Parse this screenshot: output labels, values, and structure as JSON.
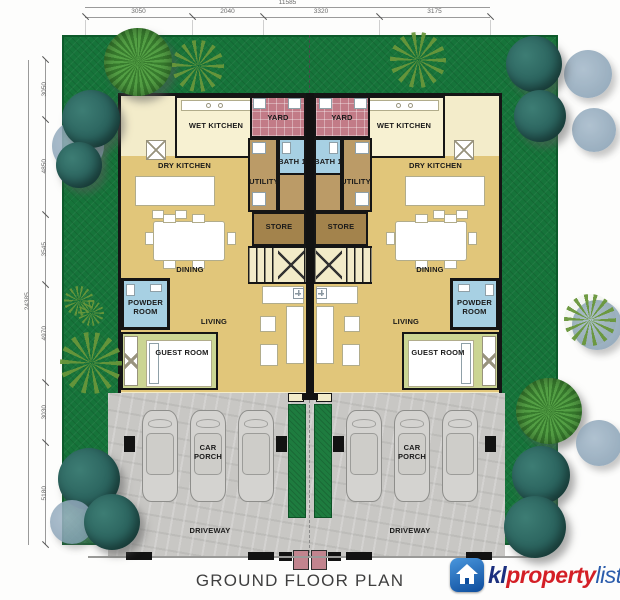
{
  "title": "GROUND FLOOR PLAN",
  "watermark": {
    "prefix": "kl",
    "middle": "property",
    "suffix": "list",
    "icon": "house-icon",
    "colors": {
      "prefix": "#1b2f7e",
      "middle": "#d41f26",
      "suffix": "#2b5cab",
      "icon_bg": "#0d4c9c"
    }
  },
  "dimensions": {
    "top": {
      "total": "11585",
      "segments": [
        "3050",
        "2040",
        "3320",
        "3175"
      ]
    },
    "left": {
      "total": "24385",
      "segments": [
        "3050",
        "4850",
        "3545",
        "4970",
        "3030",
        "5180"
      ]
    }
  },
  "rooms": {
    "wet_kitchen": "WET KITCHEN",
    "dry_kitchen": "DRY KITCHEN",
    "yard": "YARD",
    "bath": "BATH 1",
    "utility": "UTILITY",
    "store": "STORE",
    "dining": "DINING",
    "powder_room": "POWDER ROOM",
    "living": "LIVING",
    "guest_room": "GUEST ROOM",
    "car_porch": "CAR PORCH",
    "driveway": "DRIVEWAY"
  },
  "colors": {
    "grass": "#16743a",
    "building": "#f3ecca",
    "interior_gold": "#e1c67a",
    "yard_tile": "#c27b87",
    "bathroom_blue": "#a7d0e3",
    "utility_tan": "#bb9b67",
    "store_tan": "#a3834c",
    "guest_olive": "#cbd593",
    "driveway_gray": "#c8c7c4",
    "hedge": "#1e7c3f",
    "bush_teal": "#2c665f",
    "gate_pink": "#c2848e"
  }
}
